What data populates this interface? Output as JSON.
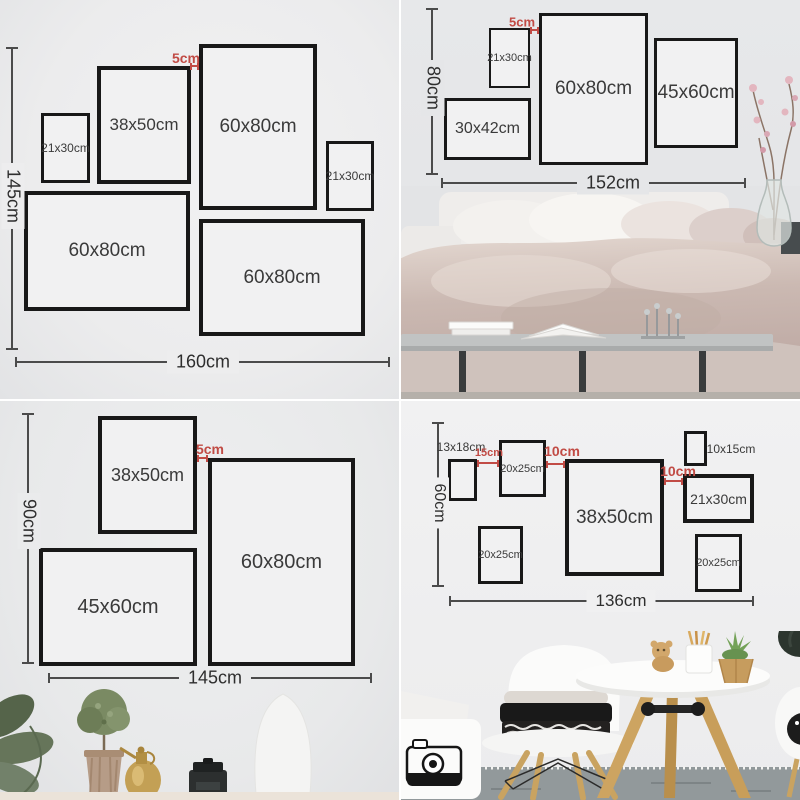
{
  "colors": {
    "accent_red": "#c14b45",
    "frame_border": "#181818",
    "dimension_line": "#4b4b4b",
    "wall_gray": "#ededee"
  },
  "quadrants": {
    "top_left": {
      "height_total": "145cm",
      "width_total": "160cm",
      "gap": "5cm",
      "frames": [
        "21x30cm",
        "38x50cm",
        "60x80cm",
        "21x30cm",
        "60x80cm",
        "60x80cm"
      ]
    },
    "top_right": {
      "height_total": "80cm",
      "width_total": "152cm",
      "gap": "5cm",
      "frames": [
        "21x30cm",
        "60x80cm",
        "45x60cm",
        "30x42cm"
      ]
    },
    "bottom_left": {
      "height_total": "90cm",
      "width_total": "145cm",
      "gap": "5cm",
      "frames": [
        "38x50cm",
        "60x80cm",
        "45x60cm"
      ]
    },
    "bottom_right": {
      "height_total": "60cm",
      "width_total": "136cm",
      "gaps": [
        "15cm",
        "10cm",
        "10cm"
      ],
      "frames": [
        "13x18cm",
        "20x25cm",
        "38x50cm",
        "10x15cm",
        "21x30cm",
        "20x25cm",
        "20x25cm"
      ]
    }
  }
}
